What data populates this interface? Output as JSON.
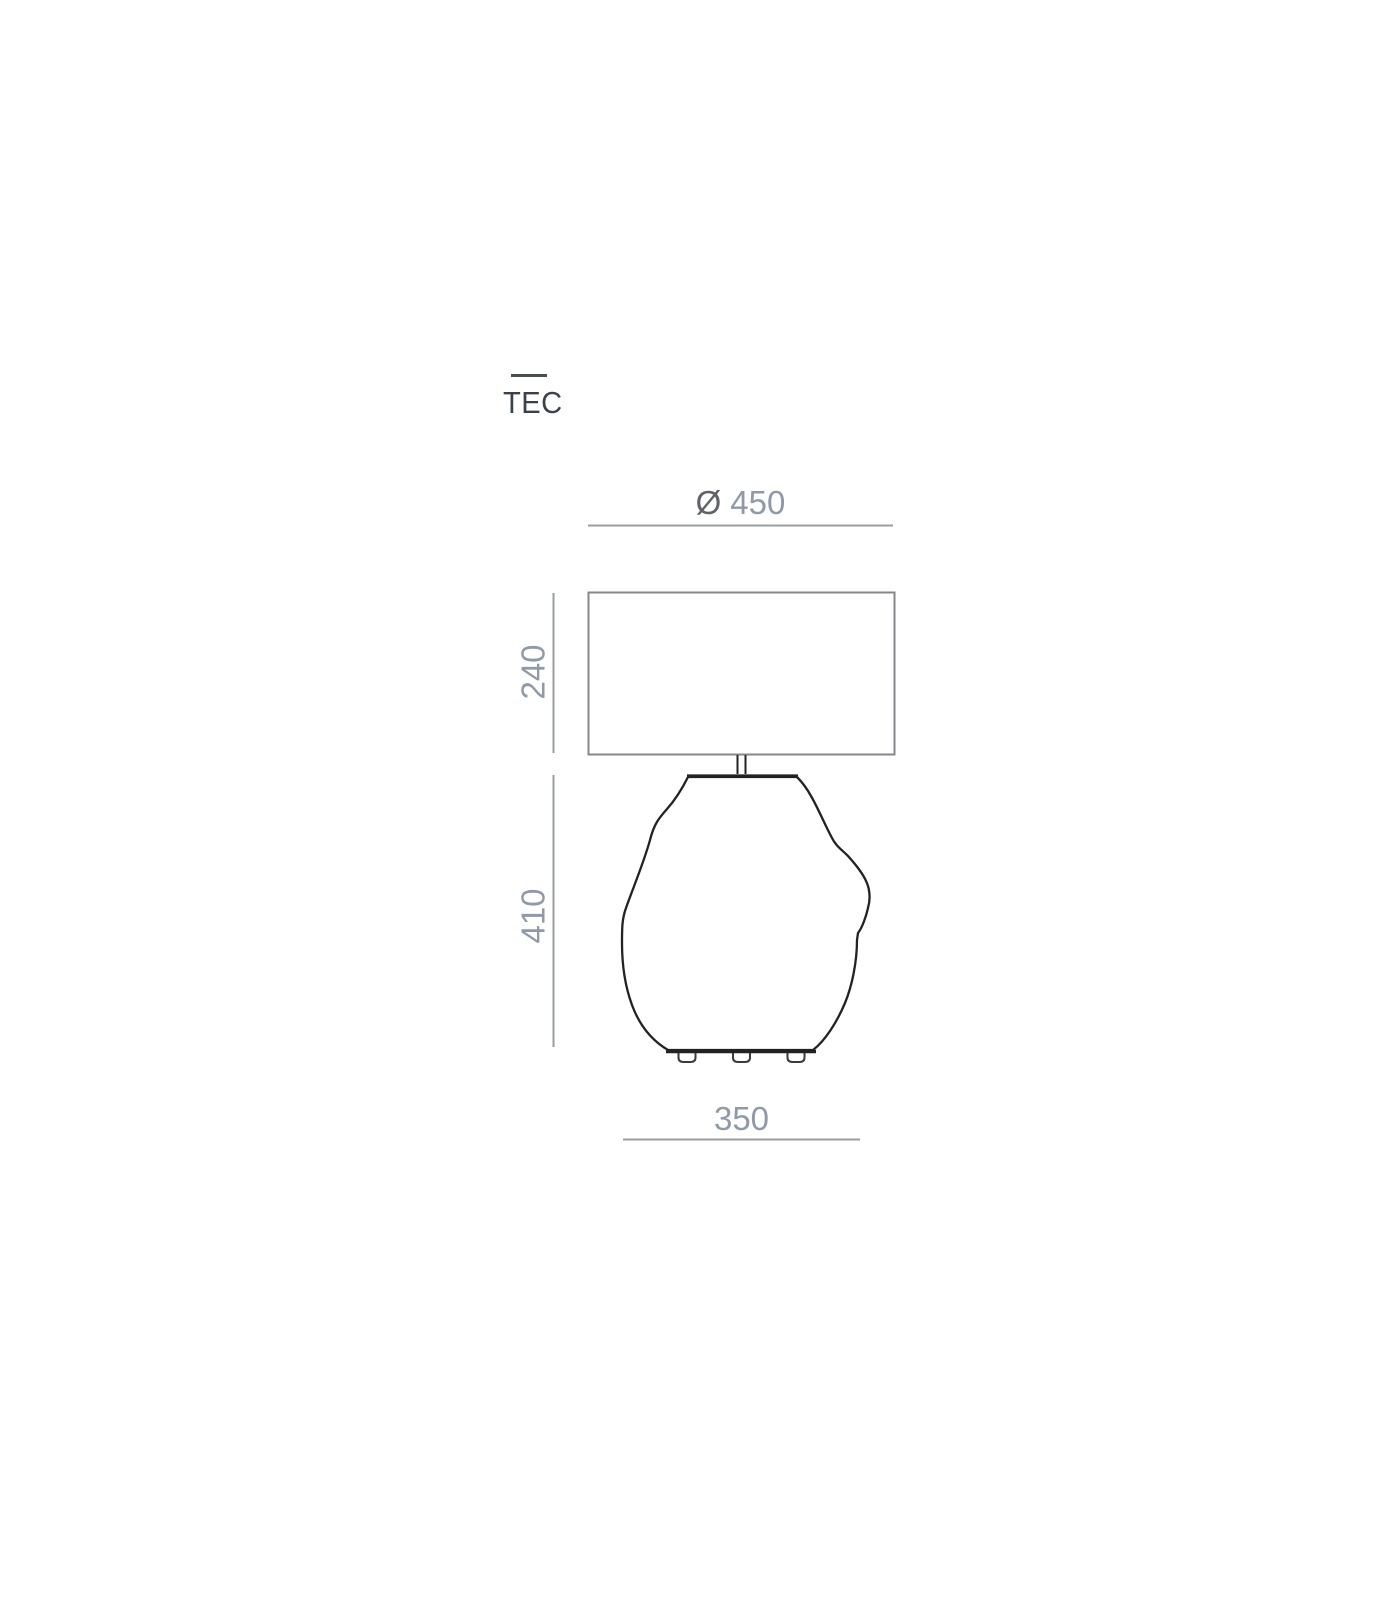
{
  "title": {
    "label": "TEC"
  },
  "dimensions": {
    "diameter": {
      "symbol": "Ø",
      "value": "450"
    },
    "shade_height": {
      "value": "240"
    },
    "body_height": {
      "value": "410"
    },
    "base_width": {
      "value": "350"
    }
  },
  "colors": {
    "bg": "#ffffff",
    "title-text": "#3a414d",
    "title-line": "#4a4d52",
    "dim-text": "#8e99a9",
    "dia-symbol": "#5f6369",
    "dim-line": "#9b9ea1",
    "shade-outline": "#85878a",
    "body-outline": "#222222",
    "foot-outline": "#3a3a3a"
  }
}
